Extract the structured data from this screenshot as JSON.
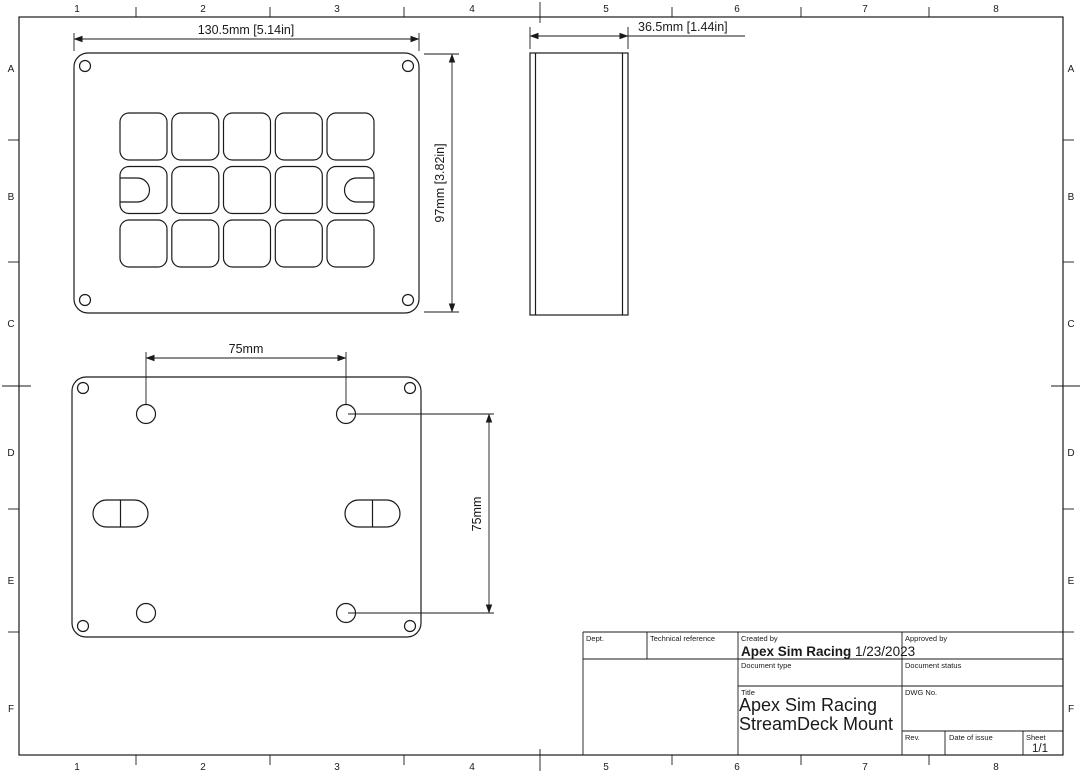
{
  "drawing": {
    "border": {
      "columns": [
        "1",
        "2",
        "3",
        "4",
        "5",
        "6",
        "7",
        "8"
      ],
      "rows": [
        "A",
        "B",
        "C",
        "D",
        "E",
        "F"
      ]
    },
    "front_view": {
      "width_dim": "130.5mm [5.14in]",
      "height_dim": "97mm [3.82in]"
    },
    "side_view": {
      "depth_dim": "36.5mm [1.44in]"
    },
    "back_view": {
      "hole_spacing_horizontal": "75mm",
      "hole_spacing_vertical": "75mm"
    },
    "title_block": {
      "dept_label": "Dept.",
      "technical_reference_label": "Technical reference",
      "created_by_label": "Created by",
      "created_by_name": "Apex Sim Racing",
      "created_by_date": " 1/23/2023",
      "approved_by_label": "Approved by",
      "document_type_label": "Document type",
      "document_status_label": "Document status",
      "title_label": "Title",
      "title_line1": "Apex Sim Racing",
      "title_line2": "StreamDeck Mount",
      "dwg_no_label": "DWG No.",
      "rev_label": "Rev.",
      "date_of_issue_label": "Date of issue",
      "sheet_label": "Sheet",
      "sheet_value": "1/1"
    },
    "colors": {
      "line": "#1a1a1a",
      "background": "#ffffff"
    }
  }
}
